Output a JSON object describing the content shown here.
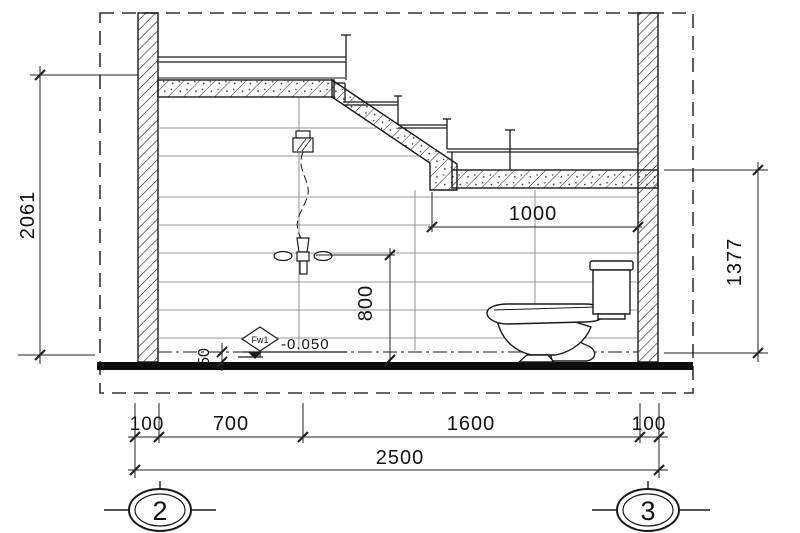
{
  "drawing": {
    "dimensions": {
      "left_height": "2061",
      "right_height": "1377",
      "landing_depth": "1000",
      "shower_mixer_height": "800",
      "floor_recess": "50",
      "bottom_segments": [
        "100",
        "700",
        "1600",
        "100"
      ],
      "overall_width": "2500"
    },
    "annotations": {
      "floor_drain_tag": "Fw1",
      "floor_level": "-0.050"
    },
    "grid_bubbles": {
      "left": "2",
      "right": "3"
    }
  },
  "colors": {
    "line": "#1a1a1a",
    "background": "#ffffff",
    "floor_fill": "#0d0d0d"
  }
}
